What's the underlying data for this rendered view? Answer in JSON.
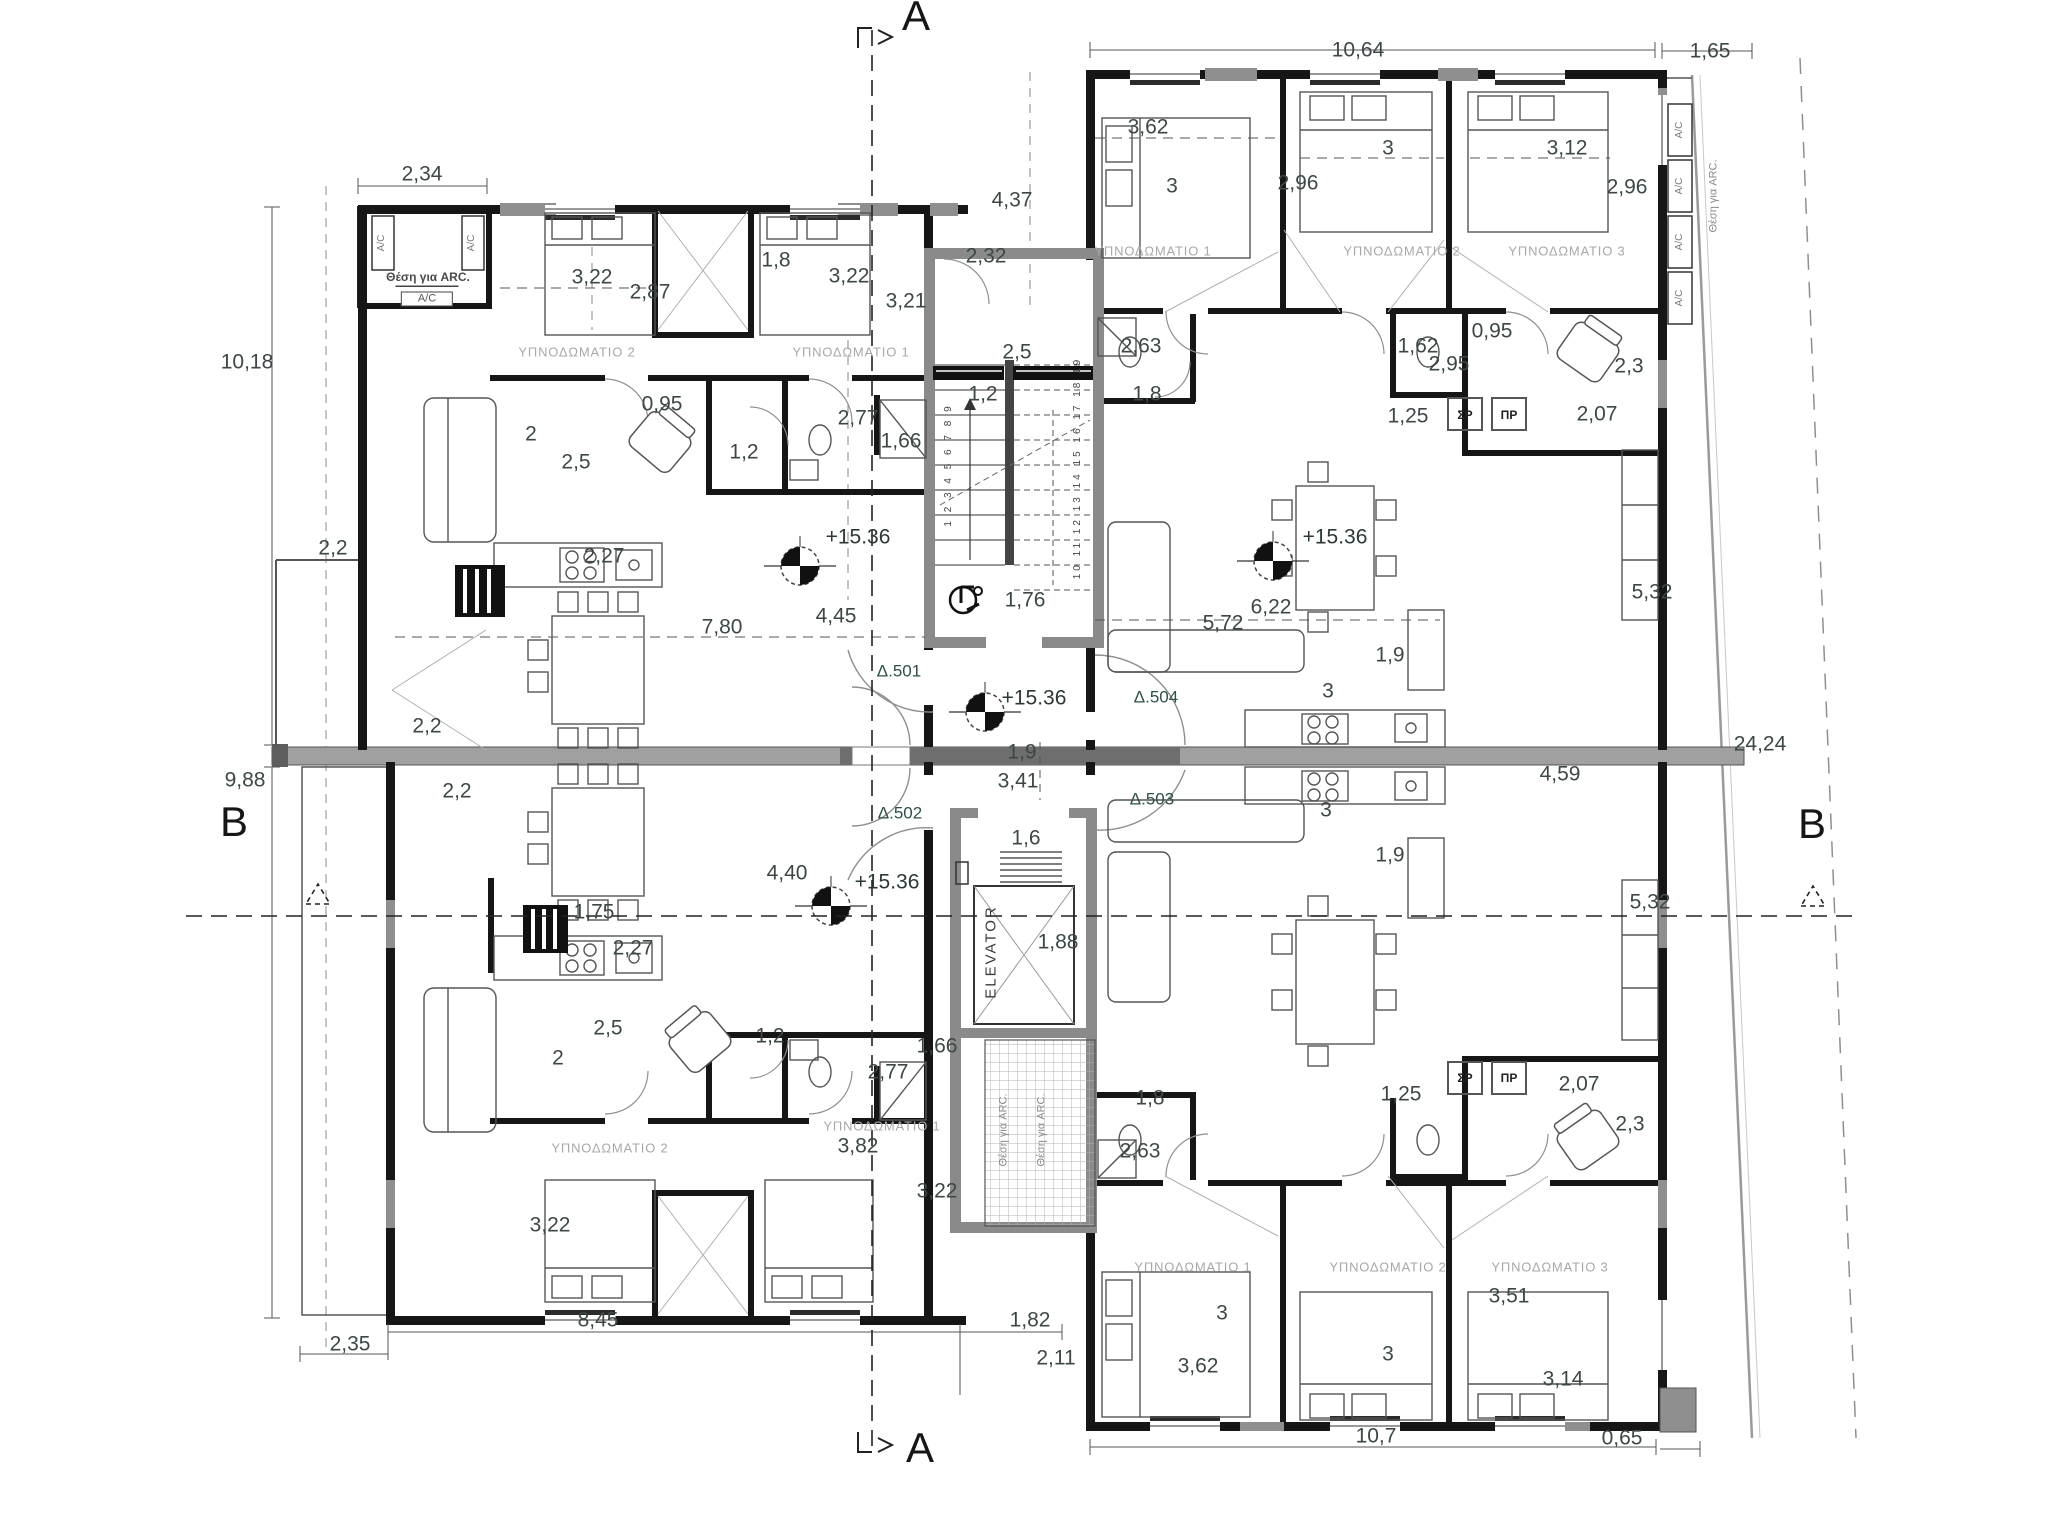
{
  "meta": {
    "drawing": "apartment floor plan",
    "level_mark": "+15.36"
  },
  "colors": {
    "wall": "#161616",
    "core_wall": "#8a8a8a",
    "slab": "#a0a0a0",
    "slab_dark": "#6e6e6e",
    "dim_text": "#3d4747",
    "room_text": "#a8a8a8",
    "apартment_text": "#2f4f4a"
  },
  "apartment_ids": [
    "Δ.501",
    "Δ.502",
    "Δ.503",
    "Δ.504"
  ],
  "labels": [
    {
      "t": "A",
      "x": 916,
      "y": 16,
      "cls": "sec"
    },
    {
      "t": "A",
      "x": 920,
      "y": 1448,
      "cls": "sec"
    },
    {
      "t": "B",
      "x": 234,
      "y": 822,
      "cls": "sec"
    },
    {
      "t": "B",
      "x": 1812,
      "y": 824,
      "cls": "sec"
    },
    {
      "t": "10,64",
      "x": 1358,
      "y": 50,
      "cls": "dim"
    },
    {
      "t": "1,65",
      "x": 1710,
      "y": 51,
      "cls": "dim"
    },
    {
      "t": "2,34",
      "x": 422,
      "y": 174,
      "cls": "dim"
    },
    {
      "t": "10,18",
      "x": 247,
      "y": 362,
      "cls": "dim"
    },
    {
      "t": "9,88",
      "x": 245,
      "y": 780,
      "cls": "dim"
    },
    {
      "t": "2,35",
      "x": 350,
      "y": 1344,
      "cls": "dim"
    },
    {
      "t": "8,45",
      "x": 598,
      "y": 1320,
      "cls": "dim"
    },
    {
      "t": "1,82",
      "x": 1030,
      "y": 1320,
      "cls": "dim"
    },
    {
      "t": "2,11",
      "x": 1056,
      "y": 1358,
      "cls": "dim"
    },
    {
      "t": "10,7",
      "x": 1376,
      "y": 1436,
      "cls": "dim"
    },
    {
      "t": "0,65",
      "x": 1622,
      "y": 1438,
      "cls": "dim"
    },
    {
      "t": "24,24",
      "x": 1760,
      "y": 744,
      "cls": "dim"
    },
    {
      "t": "5,32",
      "x": 1652,
      "y": 592,
      "cls": "dim"
    },
    {
      "t": "5,32",
      "x": 1650,
      "y": 902,
      "cls": "dim"
    },
    {
      "t": "4,59",
      "x": 1560,
      "y": 774,
      "cls": "dim"
    },
    {
      "t": "4,37",
      "x": 1012,
      "y": 200,
      "cls": "dim"
    },
    {
      "t": "2,32",
      "x": 986,
      "y": 256,
      "cls": "dim"
    },
    {
      "t": "3,22",
      "x": 592,
      "y": 277,
      "cls": "dim"
    },
    {
      "t": "2,87",
      "x": 650,
      "y": 292,
      "cls": "dim"
    },
    {
      "t": "1,8",
      "x": 776,
      "y": 260,
      "cls": "dim"
    },
    {
      "t": "3,22",
      "x": 849,
      "y": 276,
      "cls": "dim"
    },
    {
      "t": "3,21",
      "x": 906,
      "y": 301,
      "cls": "dim"
    },
    {
      "t": "ΥΠΝΟΔΩΜΑΤΙΟ 2",
      "x": 577,
      "y": 352,
      "cls": "room"
    },
    {
      "t": "ΥΠΝΟΔΩΜΑΤΙΟ 1",
      "x": 851,
      "y": 352,
      "cls": "room"
    },
    {
      "t": "0,95",
      "x": 662,
      "y": 404,
      "cls": "dim"
    },
    {
      "t": "2",
      "x": 531,
      "y": 434,
      "cls": "dim"
    },
    {
      "t": "2,5",
      "x": 576,
      "y": 462,
      "cls": "dim"
    },
    {
      "t": "1,2",
      "x": 744,
      "y": 452,
      "cls": "dim"
    },
    {
      "t": "2,77",
      "x": 858,
      "y": 418,
      "cls": "dim"
    },
    {
      "t": "1,66",
      "x": 901,
      "y": 441,
      "cls": "dim"
    },
    {
      "t": "2,27",
      "x": 604,
      "y": 556,
      "cls": "dim"
    },
    {
      "t": "2,5",
      "x": 1017,
      "y": 352,
      "cls": "dim"
    },
    {
      "t": "1,2",
      "x": 983,
      "y": 394,
      "cls": "dim"
    },
    {
      "t": "7,80",
      "x": 722,
      "y": 627,
      "cls": "dim"
    },
    {
      "t": "4,45",
      "x": 836,
      "y": 616,
      "cls": "dim"
    },
    {
      "t": "+15.36",
      "x": 858,
      "y": 537,
      "cls": "lvl"
    },
    {
      "t": "2,2",
      "x": 333,
      "y": 548,
      "cls": "dim"
    },
    {
      "t": "2,2",
      "x": 427,
      "y": 726,
      "cls": "dim"
    },
    {
      "t": "2,2",
      "x": 457,
      "y": 791,
      "cls": "dim"
    },
    {
      "t": "Δ.501",
      "x": 899,
      "y": 671,
      "cls": "apt"
    },
    {
      "t": "Δ.502",
      "x": 900,
      "y": 813,
      "cls": "apt"
    },
    {
      "t": "Δ.503",
      "x": 1152,
      "y": 799,
      "cls": "apt"
    },
    {
      "t": "Δ.504",
      "x": 1156,
      "y": 697,
      "cls": "apt"
    },
    {
      "t": "1,76",
      "x": 1025,
      "y": 600,
      "cls": "dim"
    },
    {
      "t": "1,9",
      "x": 1022,
      "y": 752,
      "cls": "dim"
    },
    {
      "t": "3,41",
      "x": 1018,
      "y": 781,
      "cls": "dim"
    },
    {
      "t": "1,6",
      "x": 1026,
      "y": 838,
      "cls": "dim"
    },
    {
      "t": "ELEVATOR",
      "x": 991,
      "y": 952,
      "cls": "elev",
      "r": -90
    },
    {
      "t": "1,88",
      "x": 1058,
      "y": 942,
      "cls": "dim"
    },
    {
      "t": "Θέση για ARC.",
      "x": 1004,
      "y": 1130,
      "cls": "arcv",
      "r": -90
    },
    {
      "t": "Θέση για ARC.",
      "x": 1042,
      "y": 1130,
      "cls": "arcv",
      "r": -90
    },
    {
      "t": "1 2 3 4 5 6 7 8 9",
      "x": 949,
      "y": 465,
      "cls": "stairs",
      "r": -90
    },
    {
      "t": "10 11 12 13 14 15 16 17 18 19",
      "x": 1078,
      "y": 468,
      "cls": "stairs",
      "r": -90
    },
    {
      "t": "3,62",
      "x": 1148,
      "y": 127,
      "cls": "dim"
    },
    {
      "t": "3",
      "x": 1172,
      "y": 186,
      "cls": "dim"
    },
    {
      "t": "3",
      "x": 1388,
      "y": 148,
      "cls": "dim"
    },
    {
      "t": "2,96",
      "x": 1298,
      "y": 183,
      "cls": "dim"
    },
    {
      "t": "3,12",
      "x": 1567,
      "y": 148,
      "cls": "dim"
    },
    {
      "t": "2,96",
      "x": 1627,
      "y": 187,
      "cls": "dim"
    },
    {
      "t": "ΥΠΝΟΔΩΜΑΤΙΟ 1",
      "x": 1153,
      "y": 251,
      "cls": "room"
    },
    {
      "t": "ΥΠΝΟΔΩΜΑΤΙΟ 2",
      "x": 1402,
      "y": 251,
      "cls": "room"
    },
    {
      "t": "ΥΠΝΟΔΩΜΑΤΙΟ 3",
      "x": 1567,
      "y": 251,
      "cls": "room"
    },
    {
      "t": "2,63",
      "x": 1141,
      "y": 346,
      "cls": "dim"
    },
    {
      "t": "1,8",
      "x": 1147,
      "y": 394,
      "cls": "dim"
    },
    {
      "t": "1,62",
      "x": 1418,
      "y": 346,
      "cls": "dim"
    },
    {
      "t": "2,95",
      "x": 1449,
      "y": 364,
      "cls": "dim"
    },
    {
      "t": "0,95",
      "x": 1492,
      "y": 331,
      "cls": "dim"
    },
    {
      "t": "1,25",
      "x": 1408,
      "y": 416,
      "cls": "dim"
    },
    {
      "t": "2,07",
      "x": 1597,
      "y": 414,
      "cls": "dim"
    },
    {
      "t": "2,3",
      "x": 1629,
      "y": 366,
      "cls": "dim"
    },
    {
      "t": "ΣΡ",
      "x": 1465,
      "y": 415,
      "cls": "wd"
    },
    {
      "t": "ΠΡ",
      "x": 1509,
      "y": 415,
      "cls": "wd"
    },
    {
      "t": "5,72",
      "x": 1223,
      "y": 623,
      "cls": "dim"
    },
    {
      "t": "6,22",
      "x": 1271,
      "y": 607,
      "cls": "dim"
    },
    {
      "t": "+15.36",
      "x": 1335,
      "y": 537,
      "cls": "lvl"
    },
    {
      "t": "1,9",
      "x": 1390,
      "y": 655,
      "cls": "dim"
    },
    {
      "t": "3",
      "x": 1328,
      "y": 691,
      "cls": "dim"
    },
    {
      "t": "A/C",
      "x": 1680,
      "y": 130,
      "cls": "acv",
      "r": -90
    },
    {
      "t": "A/C",
      "x": 1680,
      "y": 186,
      "cls": "acv",
      "r": -90
    },
    {
      "t": "A/C",
      "x": 1680,
      "y": 242,
      "cls": "acv",
      "r": -90
    },
    {
      "t": "A/C",
      "x": 1680,
      "y": 298,
      "cls": "acv",
      "r": -90
    },
    {
      "t": "Θέση για ARC.",
      "x": 1714,
      "y": 196,
      "cls": "arcv",
      "r": -90
    },
    {
      "t": "A/C",
      "x": 382,
      "y": 243,
      "cls": "acv",
      "r": -90
    },
    {
      "t": "A/C",
      "x": 472,
      "y": 243,
      "cls": "acv",
      "r": -90
    },
    {
      "t": "Θέση για ARC.",
      "x": 428,
      "y": 277,
      "cls": "arc"
    },
    {
      "t": "A/C",
      "x": 427,
      "y": 299,
      "cls": "acb"
    },
    {
      "t": "1,75",
      "x": 594,
      "y": 912,
      "cls": "dim"
    },
    {
      "t": "4,40",
      "x": 787,
      "y": 873,
      "cls": "dim"
    },
    {
      "t": "+15.36",
      "x": 887,
      "y": 882,
      "cls": "lvl"
    },
    {
      "t": "2,27",
      "x": 633,
      "y": 948,
      "cls": "dim"
    },
    {
      "t": "2,5",
      "x": 608,
      "y": 1028,
      "cls": "dim"
    },
    {
      "t": "2",
      "x": 558,
      "y": 1058,
      "cls": "dim"
    },
    {
      "t": "1,2",
      "x": 770,
      "y": 1036,
      "cls": "dim"
    },
    {
      "t": "2,77",
      "x": 888,
      "y": 1072,
      "cls": "dim"
    },
    {
      "t": "1,66",
      "x": 937,
      "y": 1046,
      "cls": "dim"
    },
    {
      "t": "ΥΠΝΟΔΩΜΑΤΙΟ 2",
      "x": 610,
      "y": 1148,
      "cls": "room"
    },
    {
      "t": "ΥΠΝΟΔΩΜΑΤΙΟ 1",
      "x": 882,
      "y": 1126,
      "cls": "room"
    },
    {
      "t": "3,82",
      "x": 858,
      "y": 1146,
      "cls": "dim"
    },
    {
      "t": "3,22",
      "x": 937,
      "y": 1191,
      "cls": "dim"
    },
    {
      "t": "3,22",
      "x": 550,
      "y": 1225,
      "cls": "dim"
    },
    {
      "t": "+15.36",
      "x": 1034,
      "y": 698,
      "cls": "lvl"
    },
    {
      "t": "3",
      "x": 1326,
      "y": 810,
      "cls": "dim"
    },
    {
      "t": "1,9",
      "x": 1390,
      "y": 855,
      "cls": "dim"
    },
    {
      "t": "1,8",
      "x": 1150,
      "y": 1098,
      "cls": "dim"
    },
    {
      "t": "2,63",
      "x": 1140,
      "y": 1151,
      "cls": "dim"
    },
    {
      "t": "1,25",
      "x": 1401,
      "y": 1094,
      "cls": "dim"
    },
    {
      "t": "2,07",
      "x": 1579,
      "y": 1084,
      "cls": "dim"
    },
    {
      "t": "2,3",
      "x": 1630,
      "y": 1124,
      "cls": "dim"
    },
    {
      "t": "ΣΡ",
      "x": 1465,
      "y": 1078,
      "cls": "wd"
    },
    {
      "t": "ΠΡ",
      "x": 1509,
      "y": 1078,
      "cls": "wd"
    },
    {
      "t": "ΥΠΝΟΔΩΜΑΤΙΟ 1",
      "x": 1193,
      "y": 1267,
      "cls": "room"
    },
    {
      "t": "ΥΠΝΟΔΩΜΑΤΙΟ 2",
      "x": 1388,
      "y": 1267,
      "cls": "room"
    },
    {
      "t": "ΥΠΝΟΔΩΜΑΤΙΟ 3",
      "x": 1550,
      "y": 1267,
      "cls": "room"
    },
    {
      "t": "3",
      "x": 1222,
      "y": 1313,
      "cls": "dim"
    },
    {
      "t": "3,51",
      "x": 1509,
      "y": 1296,
      "cls": "dim"
    },
    {
      "t": "3,62",
      "x": 1198,
      "y": 1366,
      "cls": "dim"
    },
    {
      "t": "3",
      "x": 1388,
      "y": 1354,
      "cls": "dim"
    },
    {
      "t": "3,14",
      "x": 1563,
      "y": 1379,
      "cls": "dim"
    }
  ]
}
